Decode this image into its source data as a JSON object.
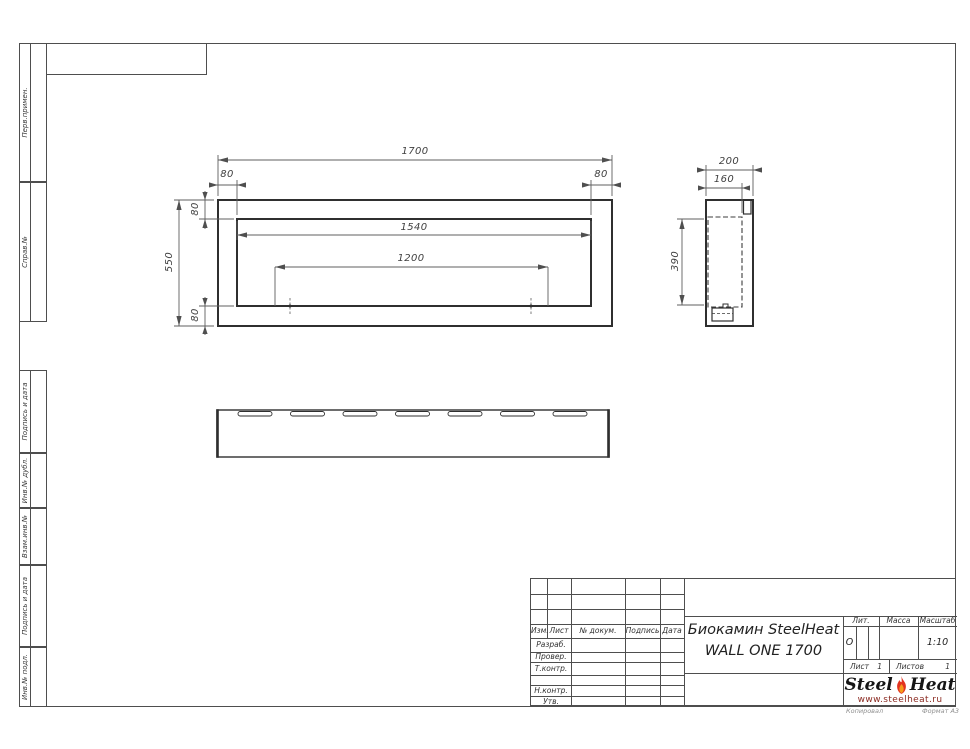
{
  "sheet": {
    "side_labels": [
      "Перв.примен.",
      "Справ.№",
      "Подпись и дата",
      "Инв.№ дубл.",
      "Взам.инв.№",
      "Подпись и дата",
      "Инв.№ подл."
    ],
    "footer": {
      "copied": "Копировал",
      "format": "Формат А3"
    }
  },
  "dimensions": {
    "d1700": "1700",
    "d1540": "1540",
    "d1200": "1200",
    "d550": "550",
    "d80": "80",
    "d200": "200",
    "d160": "160",
    "d390": "390"
  },
  "title_block": {
    "rev_headers": [
      "Изм.",
      "Лист",
      "№ докум.",
      "Подпись",
      "Дата"
    ],
    "role_rows": [
      "Разраб.",
      "Провер.",
      "Т.контр.",
      "Н.контр.",
      "Утв."
    ],
    "product": {
      "line1": "Биокамин SteelHeat",
      "line2": "WALL ONE 1700"
    },
    "lit": {
      "header": "Лит.",
      "value": "О"
    },
    "mass": {
      "header": "Масса",
      "value": ""
    },
    "scale": {
      "header": "Масштаб",
      "value": "1:10"
    },
    "sheet_row": {
      "sheet_label": "Лист",
      "sheet_value": "1",
      "sheets_label": "Листов",
      "sheets_value": "1"
    },
    "logo": {
      "steel": "Steel",
      "heat": "Heat",
      "url": "www.steelheat.ru"
    }
  }
}
